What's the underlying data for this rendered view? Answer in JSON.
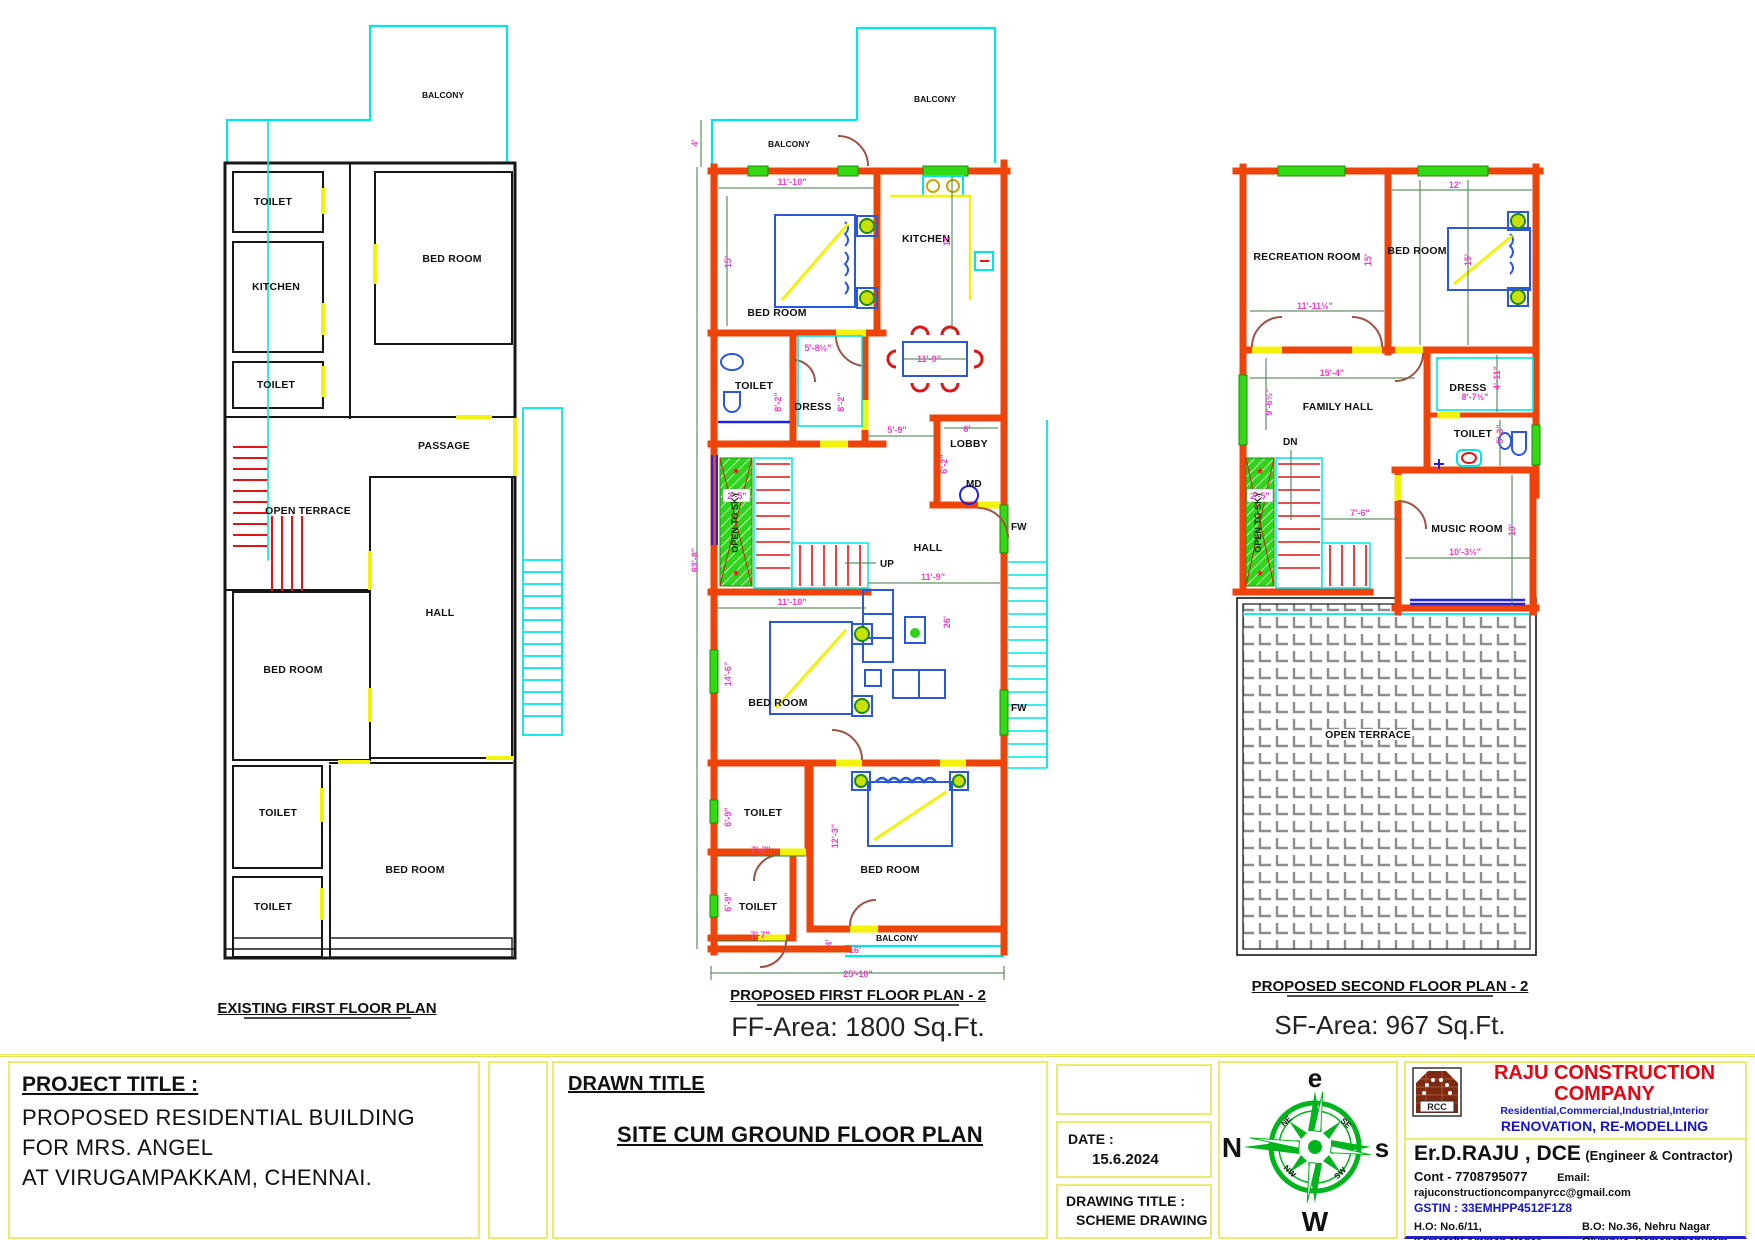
{
  "plan_existing": {
    "title": "EXISTING FIRST FLOOR PLAN",
    "rooms": {
      "balcony": "BALCONY",
      "toilet1": "TOILET",
      "kitchen": "KITCHEN",
      "toilet2": "TOILET",
      "bedroom1": "BED ROOM",
      "passage": "PASSAGE",
      "open_terrace": "OPEN TERRACE",
      "hall": "HALL",
      "bedroom2": "BED ROOM",
      "toilet3": "TOILET",
      "toilet4": "TOILET",
      "bedroom3": "BED ROOM"
    }
  },
  "plan_first": {
    "title": "PROPOSED FIRST FLOOR PLAN - 2",
    "area": "FF-Area: 1800 Sq.Ft.",
    "rooms": {
      "balcony_left": "BALCONY",
      "balcony_top": "BALCONY",
      "bedroom1": "BED ROOM",
      "kitchen": "KITCHEN",
      "toilet1": "TOILET",
      "dress": "DRESS",
      "lobby": "LOBBY",
      "md": "MD",
      "fw1": "FW",
      "fw2": "FW",
      "hall": "HALL",
      "up": "UP",
      "open_to_sky": "OPEN TO SKY",
      "bedroom2": "BED ROOM",
      "toilet2": "TOILET",
      "toilet3": "TOILET",
      "bedroom3": "BED ROOM",
      "balcony_bottom": "BALCONY"
    },
    "dims": {
      "balcony_h": "4'",
      "bed1_w": "11'-10\"",
      "bed1_h": "15'",
      "kitchen_h": "11'",
      "dining_w": "11'-9\"",
      "dress_w": "5'-8½\"",
      "toilet1_h": "8'-2\"",
      "dress_h": "8'-2\"",
      "lobby_w": "6'",
      "lobby_h": "6'-2\"",
      "dress_lobby": "5'-9\"",
      "stair_w": "2'-5\"",
      "hall_w": "11'-9\"",
      "hall_h": "26'",
      "bed2_w": "11'-10\"",
      "bed2_h": "14'-6\"",
      "toilet2_h": "6'-9\"",
      "toilet2_w": "7'-7\"",
      "toilet3_h": "6'-9\"",
      "toilet3_w": "7'-7\"",
      "bed3_h": "12'-3\"",
      "balcony_b_h": "4'",
      "balcony_b_w": "16'",
      "total_w": "25'-10\"",
      "total_h": "63'-8\""
    }
  },
  "plan_second": {
    "title": "PROPOSED SECOND FLOOR PLAN - 2",
    "area": "SF-Area: 967 Sq.Ft.",
    "rooms": {
      "recreation": "RECREATION ROOM",
      "bedroom": "BED ROOM",
      "family_hall": "FAMILY HALL",
      "dress": "DRESS",
      "toilet": "TOILET",
      "music": "MUSIC ROOM",
      "dn": "DN",
      "open_to_sky": "OPEN TO SKY",
      "open_terrace": "OPEN TERRACE"
    },
    "dims": {
      "bed_w": "12'",
      "bed_h": "15'",
      "rec_h": "15'",
      "rec_w": "11'-11½\"",
      "hall_w": "15'-4\"",
      "hall_h": "9'-6½\"",
      "dress_w": "8'-7½\"",
      "dress_h": "4'-11\"",
      "toilet_h": "5'-3\"",
      "stair_w": "2'-5\"",
      "stair_run": "7'-6\"",
      "music_w": "10'-3½\"",
      "music_h": "10'"
    }
  },
  "title_block": {
    "project_label": "PROJECT TITLE :",
    "project_lines": [
      "PROPOSED  RESIDENTIAL BUILDING",
      "FOR MRS. ANGEL",
      "AT VIRUGAMPAKKAM, CHENNAI."
    ],
    "drawn_label": "DRAWN TITLE",
    "drawn_title": "SITE CUM GROUND FLOOR PLAN",
    "date_label": "DATE  :",
    "date_value": "15.6.2024",
    "drawing_label": "DRAWING TITLE :",
    "drawing_value": "SCHEME DRAWING",
    "compass": {
      "top": "e",
      "left": "N",
      "right": "s",
      "bottom": "W",
      "ne": "NE",
      "se": "SE",
      "sw": "SW",
      "nw": "NW"
    },
    "company": {
      "logo": "RCC",
      "name": "RAJU CONSTRUCTION COMPANY",
      "tagline": "Residential,Commercial,Industrial,Interior",
      "subtitle": "RENOVATION, RE-MODELLING",
      "engineer": "Er.D.RAJU , DCE",
      "engineer_suffix": "(Engineer & Contractor)",
      "contact": "Cont - 7708795077",
      "email": "Email: rajuconstructioncompanyrcc@gmail.com",
      "gstin": "GSTIN : 33EMHPP4512F1Z8",
      "ho_lines": [
        "H.O: No.6/11,",
        "Kamatchi Amman Nagar,",
        "Mangadu, Chennai-600 010"
      ],
      "bo_lines": [
        "B.O: No.36, Nehru Nagar",
        "Olympus, Ramanathapuram,",
        "Coimbatore-641 045"
      ]
    }
  }
}
